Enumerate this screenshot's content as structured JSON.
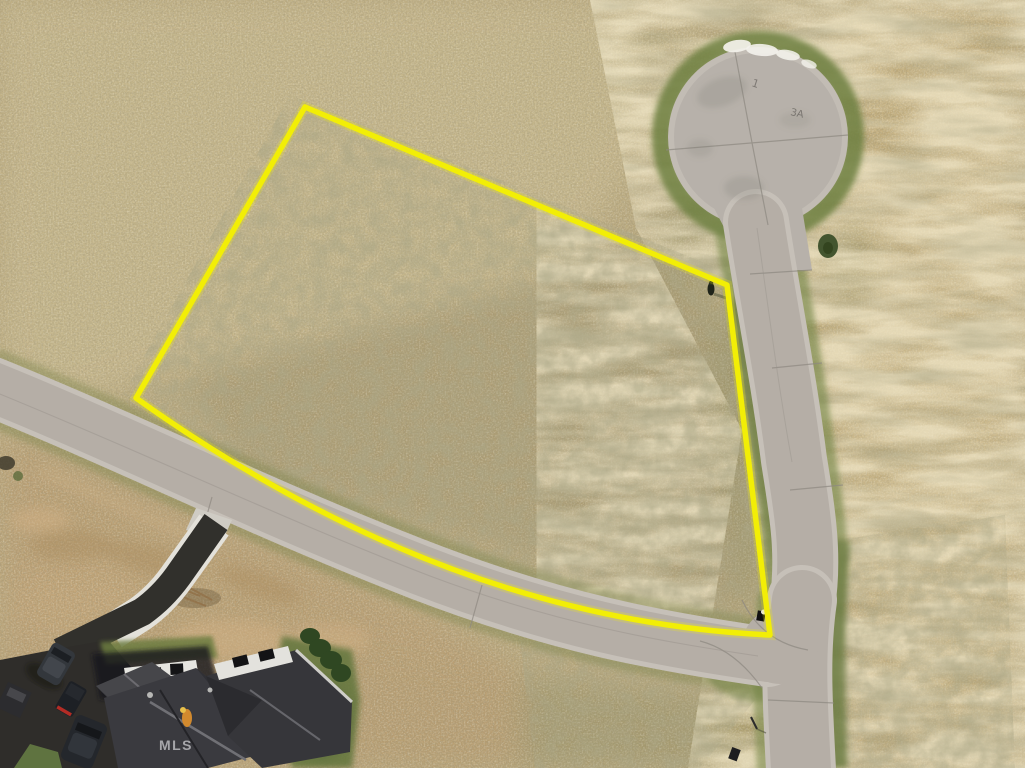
{
  "photo": {
    "watermark": "MLS",
    "pavement_marks": {
      "lot_label": "3A",
      "stub_mark": "1"
    },
    "annotation": {
      "type": "property-boundary-outline",
      "color": "#f2ee06",
      "vertices_px": [
        [
          305,
          107
        ],
        [
          727,
          285
        ],
        [
          770,
          635
        ],
        [
          136,
          398
        ]
      ],
      "bottom_edge": "curved along road frontage"
    },
    "palette": {
      "field_tan": "#bcab7f",
      "field_gold": "#c8b17e",
      "lot_olive": "#a29468",
      "road_gray": "#b5aea6",
      "road_edge_light": "#c6c0b8",
      "grass_green": "#72823f",
      "asphalt_dark": "#2f2d2a",
      "roof_gray": "#3a3a3f",
      "boundary_yellow": "#f2ee06"
    },
    "objects": [
      "grass-field",
      "cul-de-sac",
      "street",
      "vacant-lot-outline",
      "house-under-construction",
      "driveway",
      "parked-vehicles",
      "person-in-field"
    ]
  }
}
